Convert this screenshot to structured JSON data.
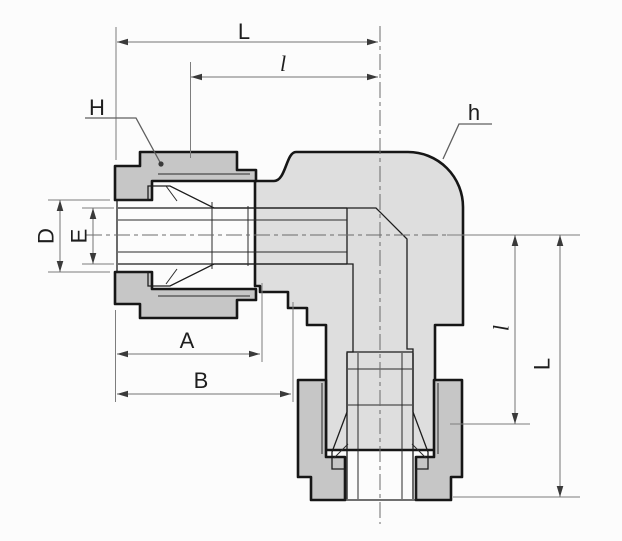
{
  "labels": {
    "dim_L_top": "L",
    "dim_l_top": "l",
    "callout_H": "H",
    "callout_h": "h",
    "dim_D": "D",
    "dim_E": "E",
    "dim_A": "A",
    "dim_B": "B",
    "dim_l_right": "l",
    "dim_L_right": "L"
  },
  "colors": {
    "background": "#fcfcfc",
    "body_fill": "#dedede",
    "nut_fill": "#c6c6c6",
    "cavity_fill": "#ffffff",
    "outline": "#161616",
    "dimension_line": "#757575",
    "label_text": "#1e1e1e"
  }
}
